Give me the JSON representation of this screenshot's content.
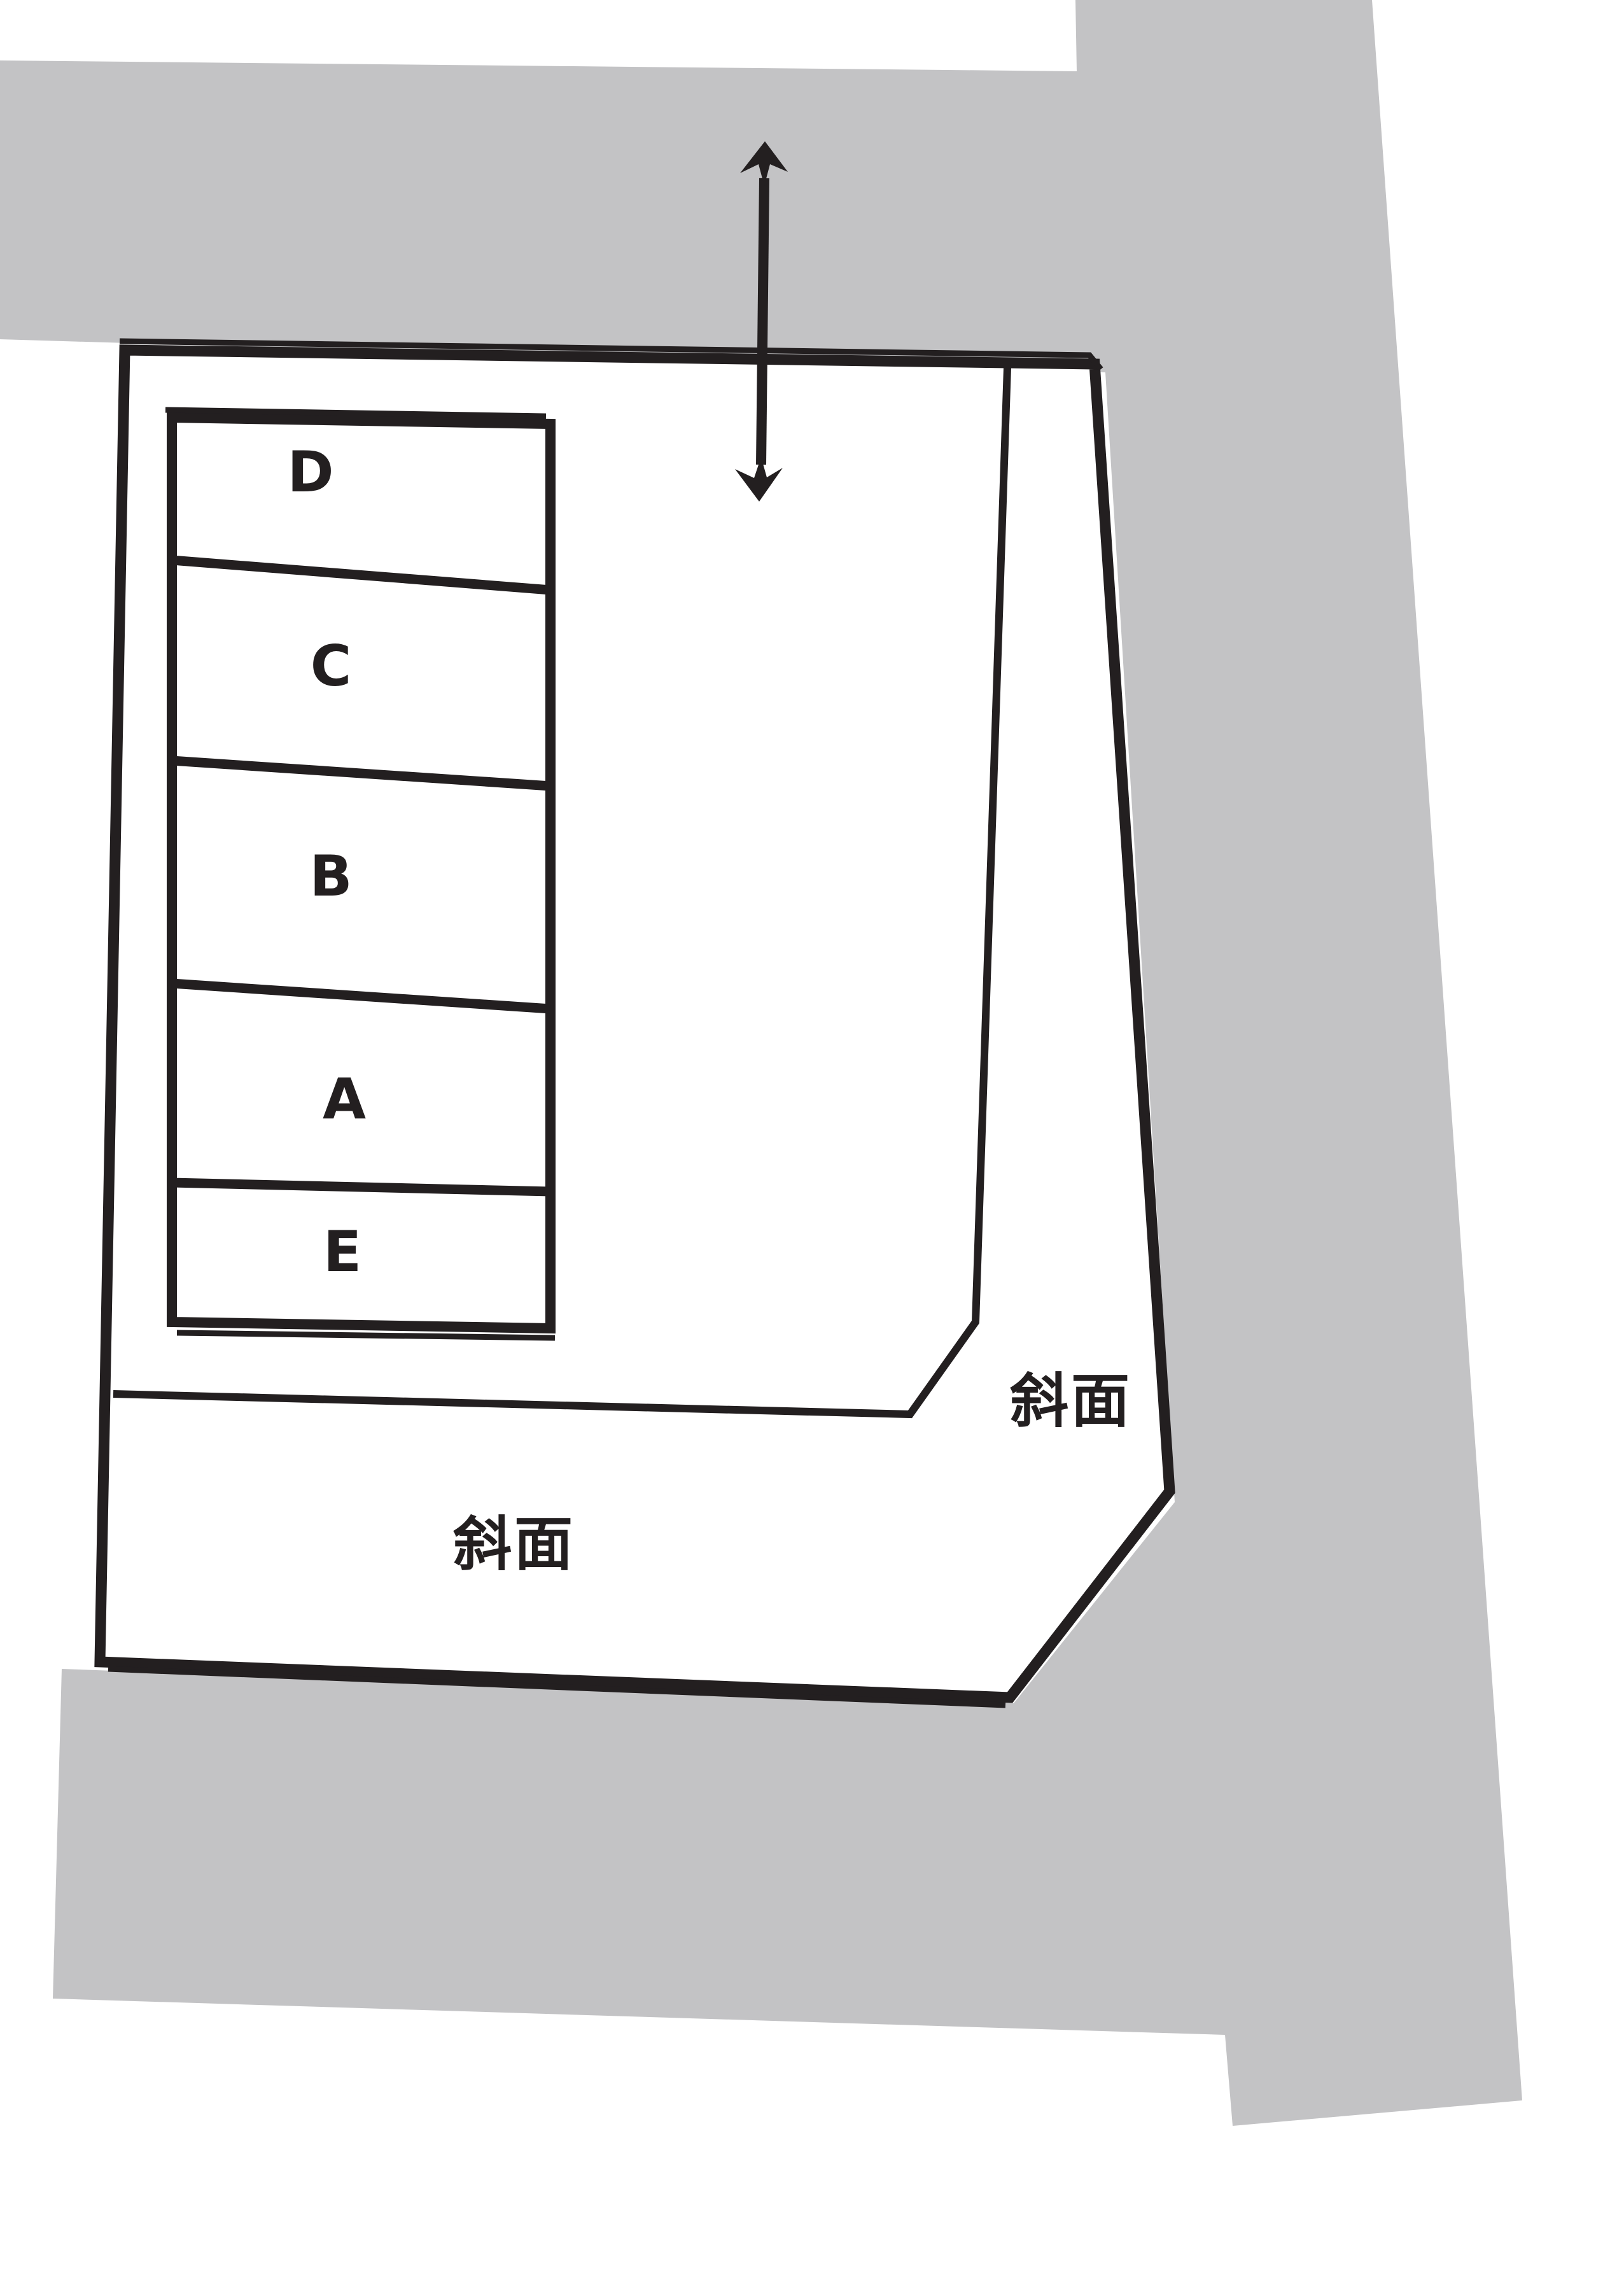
{
  "diagram_type": "land-plot-site-plan",
  "colors": {
    "road": "#c3c3c5",
    "line": "#231f20",
    "background": "#ffffff",
    "text": "#231f20"
  },
  "parking_rows": [
    {
      "label": "D"
    },
    {
      "label": "C"
    },
    {
      "label": "B"
    },
    {
      "label": "A"
    },
    {
      "label": "E"
    }
  ],
  "slope_labels": {
    "bottom": "斜面",
    "right": "斜面"
  },
  "icons": {
    "access_arrow": "double-headed-vertical-arrow"
  }
}
